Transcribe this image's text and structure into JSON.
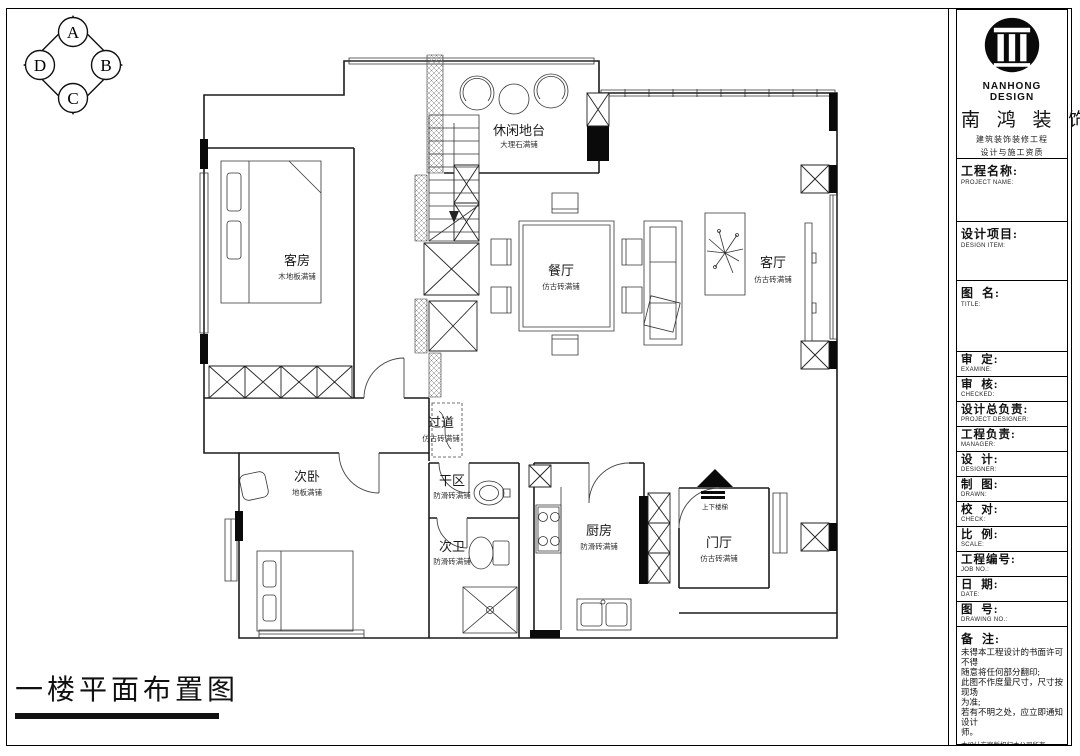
{
  "sheet": {
    "title": "一楼平面布置图"
  },
  "compass": {
    "top": "A",
    "right": "B",
    "bottom": "C",
    "left": "D"
  },
  "plan": {
    "rooms": [
      {
        "name": "休闲地台",
        "finish": "大理石满铺"
      },
      {
        "name": "客房",
        "finish": "木地板满铺"
      },
      {
        "name": "餐厅",
        "finish": "仿古砖满铺"
      },
      {
        "name": "客厅",
        "finish": "仿古砖满铺"
      },
      {
        "name": "过道",
        "finish": "仿古砖满铺"
      },
      {
        "name": "次卧",
        "finish": "地板满铺"
      },
      {
        "name": "干区",
        "finish": "防滑砖满铺"
      },
      {
        "name": "次卫",
        "finish": "防滑砖满铺"
      },
      {
        "name": "厨房",
        "finish": "防滑砖满铺"
      },
      {
        "name": "门厅",
        "finish": "仿古砖满铺"
      }
    ],
    "entry_label": "上下楼梯"
  },
  "brand": {
    "logo_text": "NANHONG DESIGN",
    "name_cn": "南 鸿 装 饰",
    "line1": "建筑装饰装修工程",
    "line2": "设计与施工资质",
    "line3": "400-1233621306"
  },
  "titleblock": {
    "fields": [
      {
        "cn": "工程名称:",
        "en": "PROJECT NAME:"
      },
      {
        "cn": "设计项目:",
        "en": "DESIGN ITEM:"
      },
      {
        "cn": "图  名:",
        "en": "TITLE:"
      },
      {
        "cn": "审  定:",
        "en": "EXAMINE:"
      },
      {
        "cn": "审  核:",
        "en": "CHECKED:"
      },
      {
        "cn": "设计总负责:",
        "en": "PROJECT DESIGNER:"
      },
      {
        "cn": "工程负责:",
        "en": "MANAGER:"
      },
      {
        "cn": "设  计:",
        "en": "DESIGNER:"
      },
      {
        "cn": "制  图:",
        "en": "DRAWN:"
      },
      {
        "cn": "校  对:",
        "en": "CHECK:"
      },
      {
        "cn": "比  例:",
        "en": "SCALE:"
      },
      {
        "cn": "工程编号:",
        "en": "JOB NO.:"
      },
      {
        "cn": "日  期:",
        "en": "DATE:"
      },
      {
        "cn": "图  号:",
        "en": "DRAWING NO.:"
      }
    ],
    "remark": {
      "label": "备  注:",
      "lines": [
        "未得本工程设计的书面许可不得",
        "随意将任何部分翻印;",
        "此图不作度量尺寸，尺寸按现场",
        "为准;",
        "若有不明之处，应立即通知设计",
        "师。",
        "本设计方案版权归本公司所有。"
      ],
      "phone": "免费咨询电话：4008383188"
    }
  }
}
